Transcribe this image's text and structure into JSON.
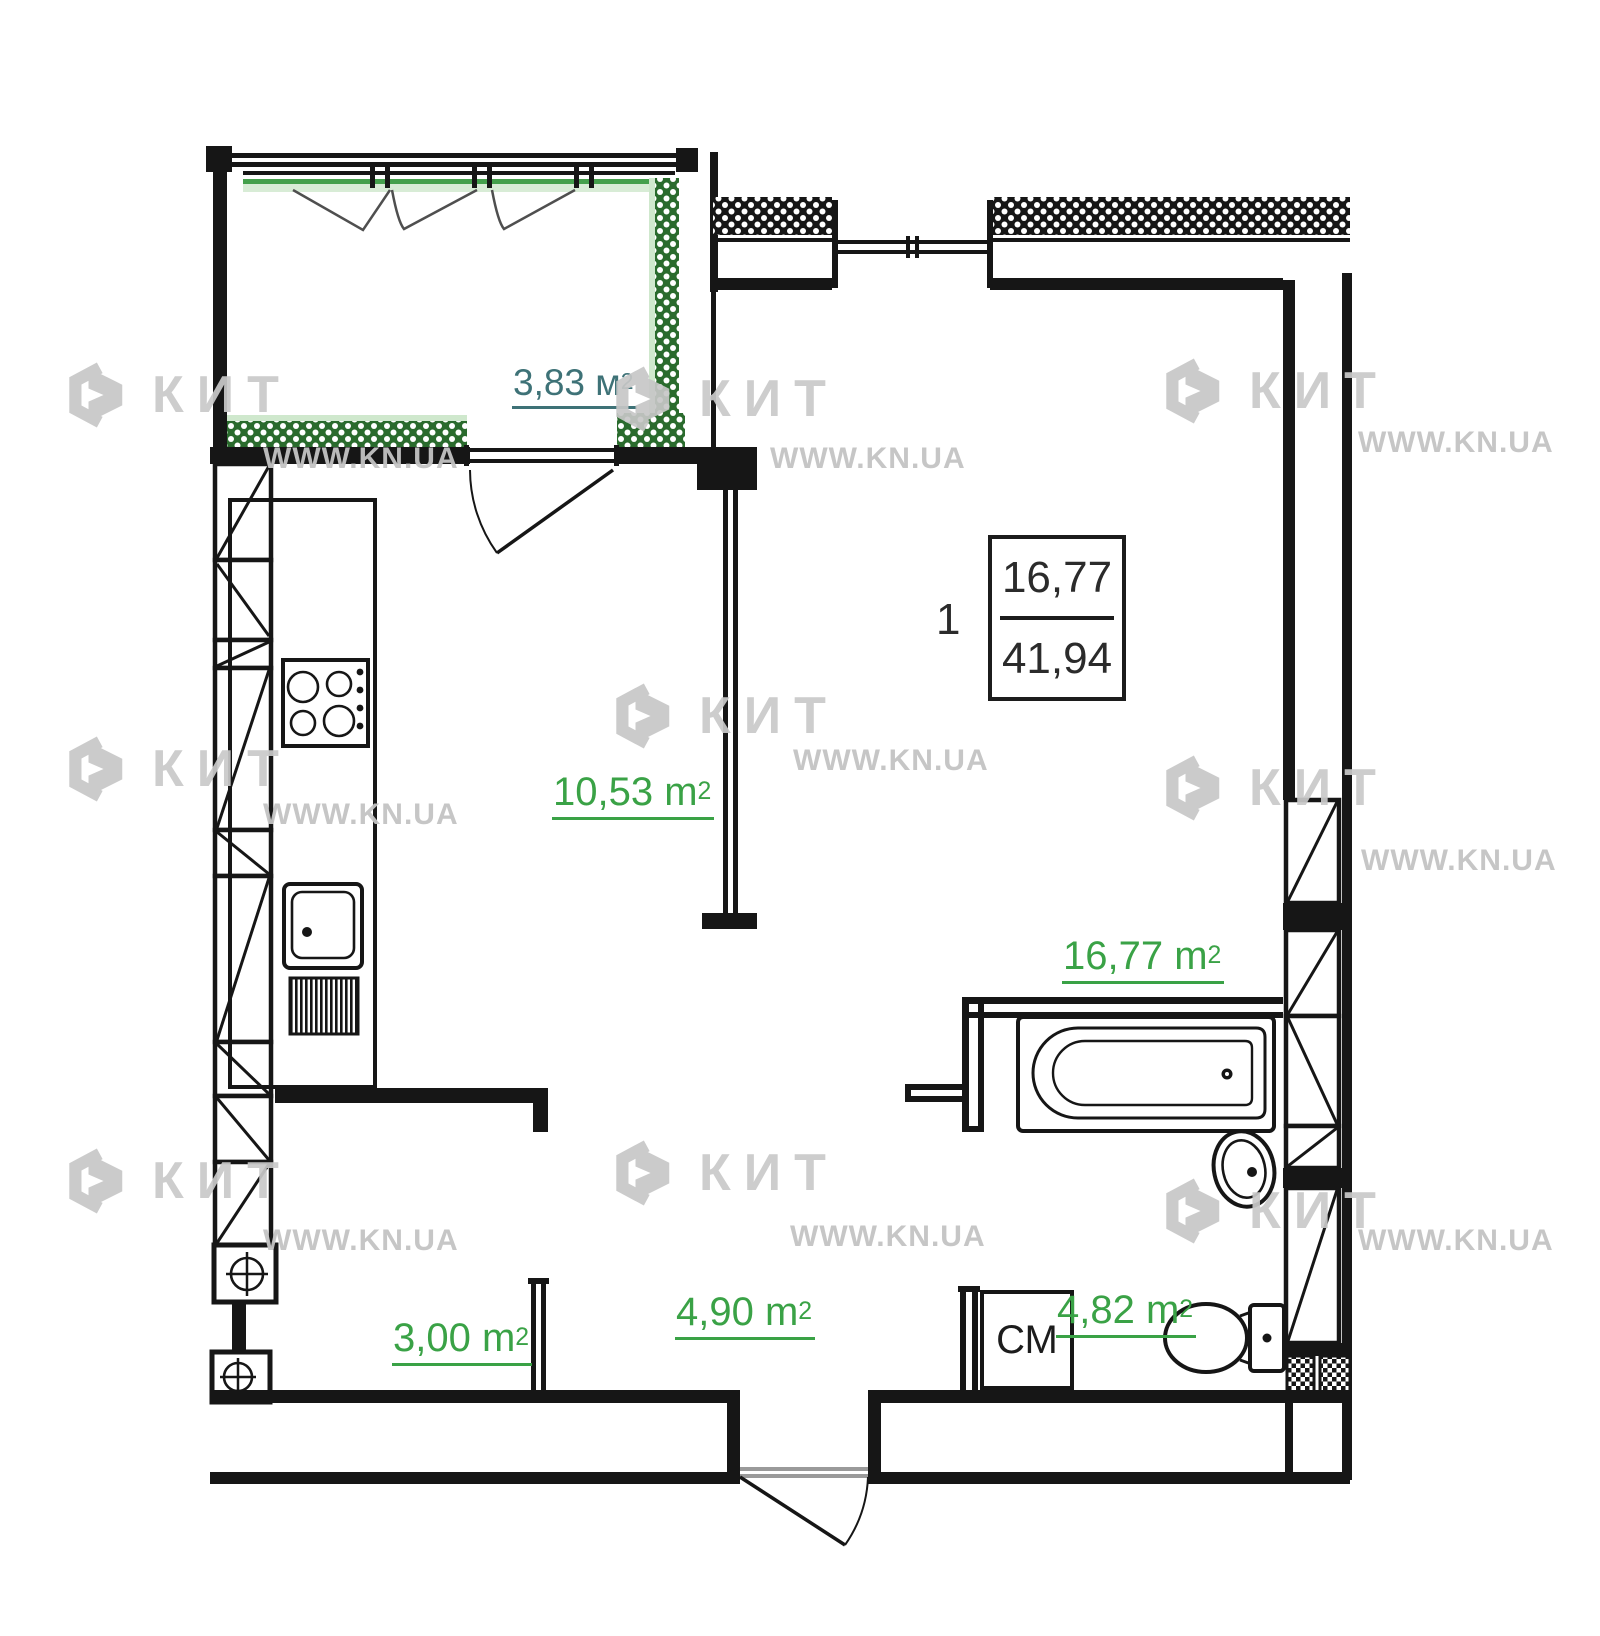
{
  "watermark": {
    "brand": "КИТ",
    "site": "WWW.KN.UA"
  },
  "apartment": {
    "count": "1",
    "living_area": "16,77",
    "total_area": "41,94"
  },
  "rooms": {
    "balcony": {
      "area": "3,83 м",
      "sup": "2"
    },
    "kitchen": {
      "area": "10,53 m",
      "sup": "2"
    },
    "living": {
      "area": "16,77 m",
      "sup": "2"
    },
    "hall": {
      "area": "3,00 m",
      "sup": "2"
    },
    "corridor": {
      "area": "4,90 m",
      "sup": "2"
    },
    "bathroom": {
      "area": "4,82 m",
      "sup": "2"
    }
  },
  "fixtures": {
    "washing_machine": "СМ"
  },
  "colors": {
    "area_label_green": "#3aa246",
    "balcony_label_teal": "#3e7277",
    "wall_black": "#161616",
    "balcony_hatch_green": "#2a6b2d",
    "watermark_gray": "#c9c9c9"
  }
}
